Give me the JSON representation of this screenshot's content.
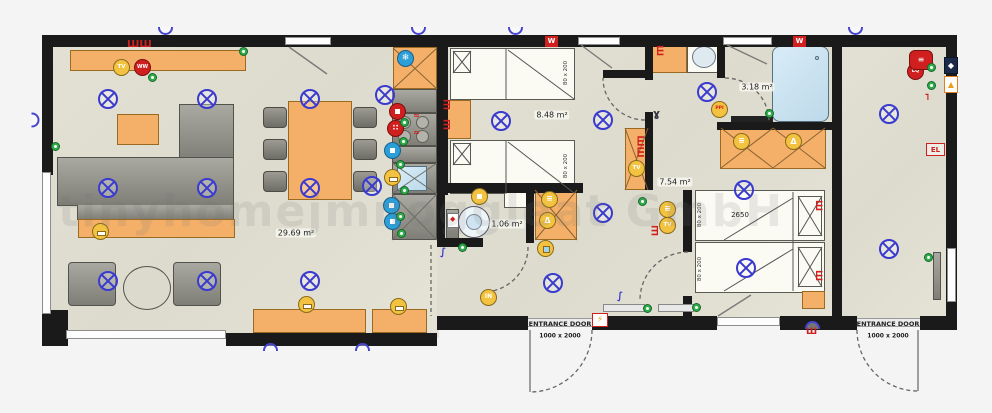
{
  "watermark": "tinyhomejmnoggleat GmbH",
  "rooms": {
    "living_area": "29.69 m²",
    "bedroom1_area": "8.48 m²",
    "toilet_area": "1.06 m²",
    "bathroom_area": "3.18 m²",
    "hallway_area": "7.54 m²"
  },
  "beds": {
    "single_bed_size": "80 x 200",
    "double_bed_width": "2650"
  },
  "entrance": {
    "label": "ENTRANCE DOOR",
    "size": "1000 x 2000"
  },
  "markers": {
    "tv": "TV",
    "heater": "WW",
    "washer": "W",
    "electrical_panel": "EL",
    "entry_light": "IN",
    "boiler_code": "LQ",
    "motion_sensor": "PPI"
  },
  "colors": {
    "wall": "#1a1a1a",
    "floor": "#e1dfd2",
    "furniture_orange": "#f4b069",
    "light_symbol_blue": "#3a3ace",
    "socket_green": "#2fae4a",
    "accent_red": "#cf1f1f",
    "switch_yellow": "#f2c240",
    "shower_blue": "#cfe6f4"
  }
}
